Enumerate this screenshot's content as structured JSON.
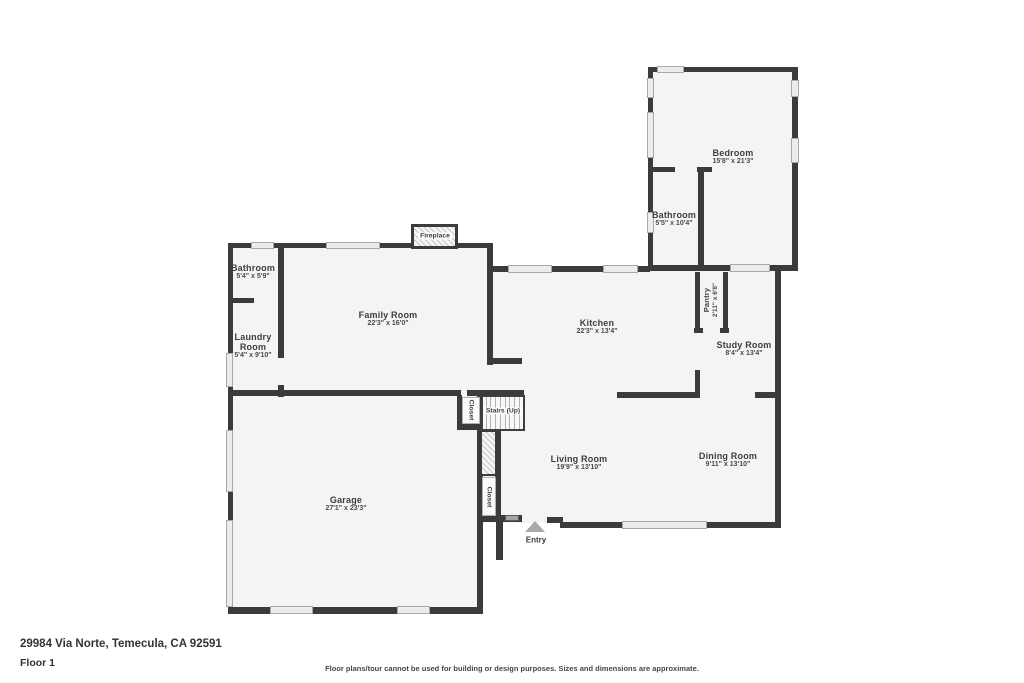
{
  "floor_plan": {
    "rooms": {
      "bedroom": {
        "name": "Bedroom",
        "dims": "15'8\" x 21'3\""
      },
      "bathroom_upper": {
        "name": "Bathroom",
        "dims": "5'5\" x 10'4\""
      },
      "bathroom_main": {
        "name": "Bathroom",
        "dims": "5'4\" x 5'9\""
      },
      "laundry_room": {
        "name": "Laundry Room",
        "dims": "5'4\" x 9'10\""
      },
      "family_room": {
        "name": "Family Room",
        "dims": "22'3\" x 16'0\""
      },
      "kitchen": {
        "name": "Kitchen",
        "dims": "22'3\" x 13'4\""
      },
      "pantry": {
        "name": "Pantry",
        "dims": "2'11\" x 6'8\""
      },
      "study_room": {
        "name": "Study Room",
        "dims": "8'4\" x 13'4\""
      },
      "living_room": {
        "name": "Living Room",
        "dims": "19'9\" x 13'10\""
      },
      "dining_room": {
        "name": "Dining Room",
        "dims": "9'11\" x 13'10\""
      },
      "garage": {
        "name": "Garage",
        "dims": "27'1\" x 23'3\""
      }
    },
    "features": {
      "fireplace": "Fireplace",
      "stairs": "Stairs (Up)",
      "closet_upper": "Closet",
      "closet_lower": "Closet",
      "entry": "Entry"
    }
  },
  "footer": {
    "address": "29984 Via Norte, Temecula, CA 92591",
    "floor_label": "Floor 1",
    "disclaimer": "Floor plans/tour cannot be used for building or design purposes. Sizes and dimensions are approximate."
  },
  "colors": {
    "wall": "#3b3b3b",
    "floor": "#f4f4f4",
    "window_fill": "#ececec",
    "label_text": "#3d3d3d"
  }
}
